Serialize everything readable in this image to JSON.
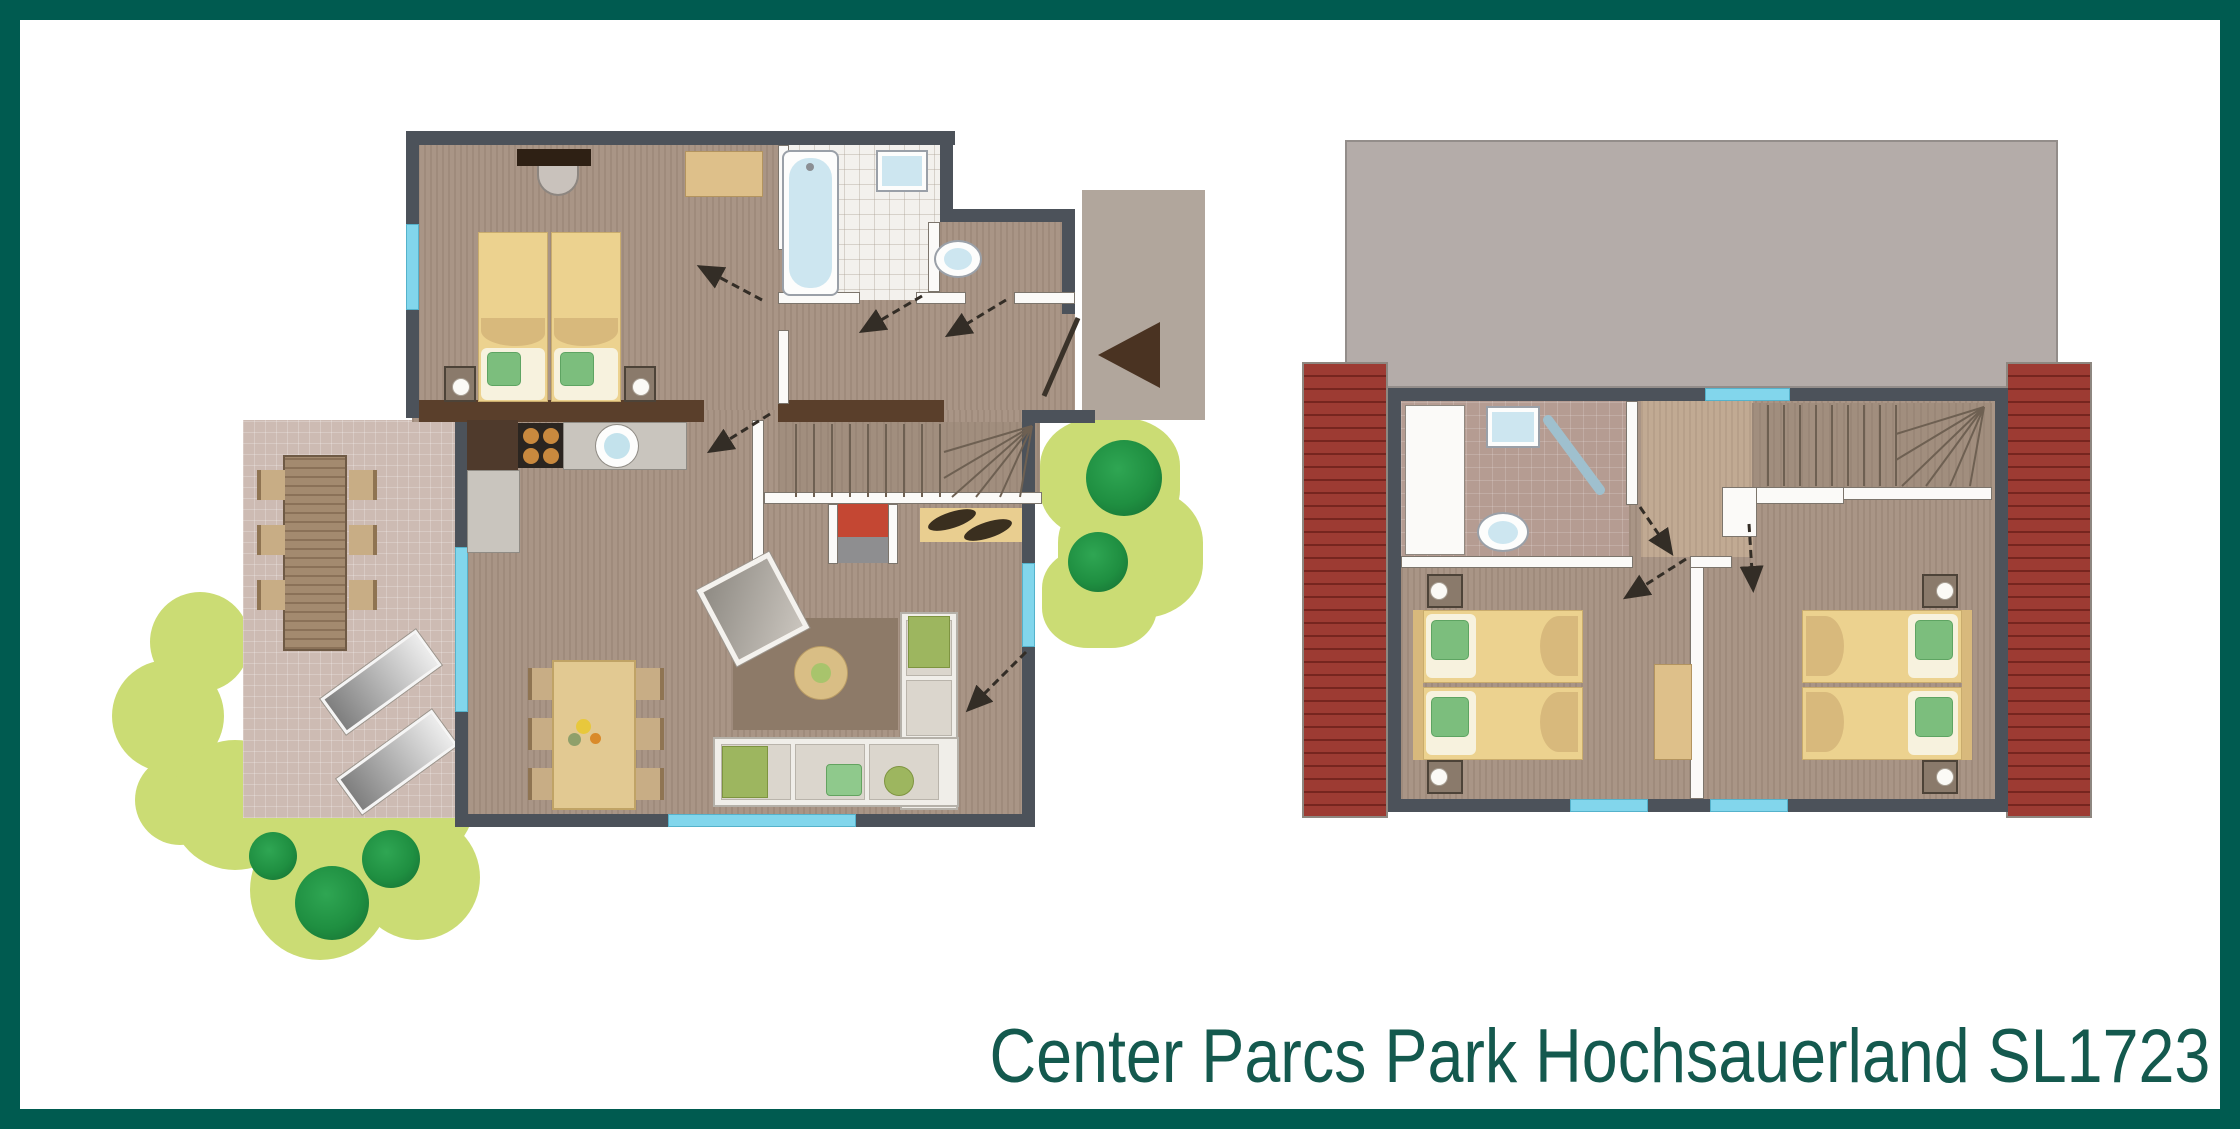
{
  "title": {
    "text": "Center Parcs Park Hochsauerland SL1723"
  },
  "colors": {
    "frame": "#005B50",
    "title-text": "#14594E",
    "wall": "#4C525A",
    "wall-brown": "#5A3F2B",
    "white-wall": "#FBFAF8",
    "wood": "#A99586",
    "tile-white": "#F3F1ED",
    "tile-pink": "#B59C92",
    "terrace": "#CDBBB3",
    "porch": "#B1A69C",
    "window": "#82D6EC",
    "bed-duvet": "#ECD28F",
    "bed-sheet": "#F7F2DE",
    "pillow-green": "#7CBE7D",
    "fold-tan": "#D8B97C",
    "nightstand": "#8A7A6B",
    "wardrobe": "#DEC08A",
    "counter": "#C9C5BE",
    "stove": "#2B2520",
    "burner": "#C9893E",
    "sink-blue": "#C3E2EC",
    "stairs": "#A18E7E",
    "step-line": "#6E6052",
    "fireplace-red": "#C44733",
    "fireplace-gray": "#8E8E90",
    "doormat": "#E9CE90",
    "rug": "#8D7A68",
    "sofa-frame": "#F0EEE9",
    "cushion": "#DBD6CD",
    "pillow-olive": "#9DB65F",
    "dining-table": "#E2C992",
    "chair-tan": "#C8AD85",
    "wood-table": "#A38A6F",
    "bush-green": "#CBDC74",
    "tree-green": "#1F8F41",
    "roof-red": "#9D3B33",
    "roof-red-line": "#76251F",
    "roof-gray": "#B4ACA9",
    "bath-fixture": "#CDE6F0",
    "arrow": "#332D26"
  },
  "ground_floor_items": [
    "double-bed",
    "washbasin",
    "wardrobe",
    "bathtub",
    "bathroom-sink",
    "toilet",
    "staircase",
    "fireplace",
    "kitchen-counter",
    "stove",
    "kitchen-sink",
    "dining-table",
    "corner-sofa",
    "coffee-table",
    "tv",
    "rug",
    "doormat",
    "entrance-arrow",
    "terrace-table",
    "sun-loungers",
    "bushes",
    "trees"
  ],
  "upper_floor_items": [
    "roof-slab",
    "roof-left",
    "roof-right",
    "bathroom-sink",
    "shower",
    "toilet",
    "staircase",
    "double-bed-left",
    "double-bed-right",
    "cabinet",
    "windows"
  ]
}
